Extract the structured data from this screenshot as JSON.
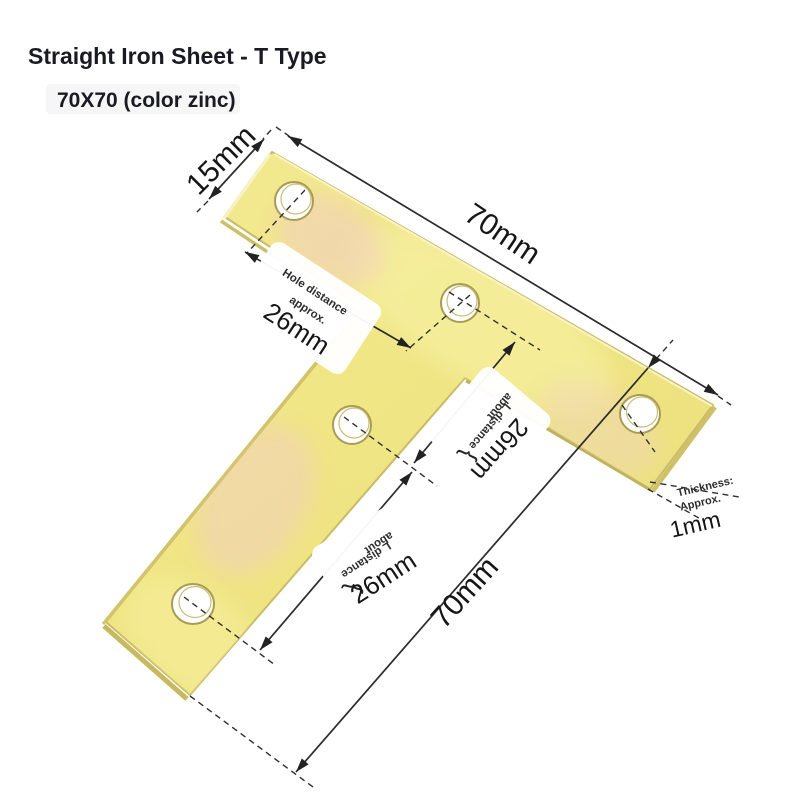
{
  "page": {
    "title": "Straight Iron Sheet - T Type",
    "subtitle": "70X70 (color zinc)"
  },
  "dimensions": {
    "end_width": "15mm",
    "bar_length": "70mm",
    "total_height": "70mm",
    "hole_distance": {
      "line1": "Hole distance",
      "line2": "approx.",
      "value": "26mm"
    },
    "mid_distance": {
      "line1": "about",
      "line2": "L distance",
      "brace": "{",
      "value": "26mm"
    },
    "leg_distance": {
      "line1": "about",
      "line2": "L distance",
      "brace": "{",
      "value": "26mm"
    },
    "thickness": {
      "line1": "Thickness:",
      "line2": "Approx.",
      "value": "1mm"
    }
  },
  "colors": {
    "background": "#ffffff",
    "plate": "#f1e88b",
    "plate_highlight": "#f8f2a8",
    "plate_pink": "#f2cfc0",
    "plate_edge": "#c9bb66",
    "dimension_line": "#2b2b2b",
    "text": "#161616"
  }
}
